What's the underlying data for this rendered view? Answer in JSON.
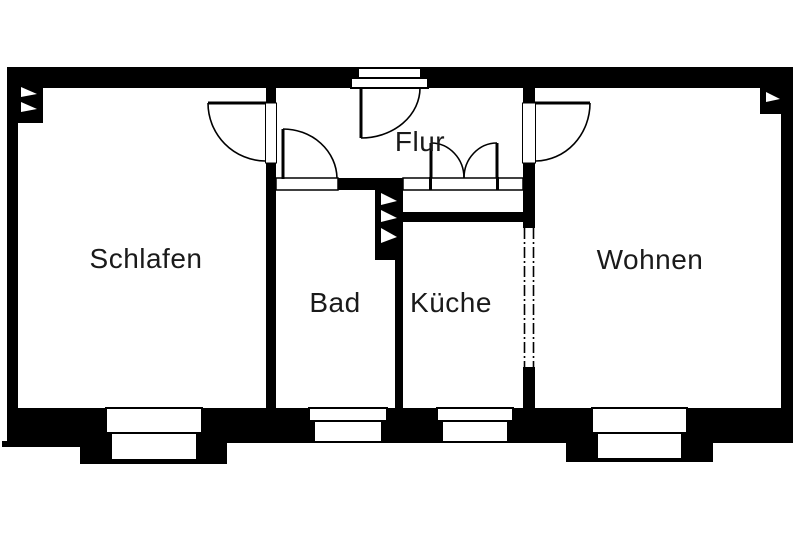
{
  "plan": {
    "type": "floor-plan",
    "rooms": {
      "schlafen": {
        "label": "Schlafen"
      },
      "flur": {
        "label": "Flur"
      },
      "bad": {
        "label": "Bad"
      },
      "kueche": {
        "label": "Küche"
      },
      "wohnen": {
        "label": "Wohnen"
      }
    },
    "features": {
      "entrance_door": "top wall of Flur",
      "double_swing_door": "Flur to Küche",
      "single_doors": [
        "Flur to Schlafen",
        "Flur to Bad",
        "Flur to Wohnen"
      ],
      "windows_bottom_wall": 4,
      "dashed_wall_section": "between Küche and Wohnen",
      "shaft_block": "between Bad and Flur"
    },
    "colors": {
      "wall": "#000000",
      "background": "#ffffff",
      "text": "#1a1a1a"
    }
  }
}
